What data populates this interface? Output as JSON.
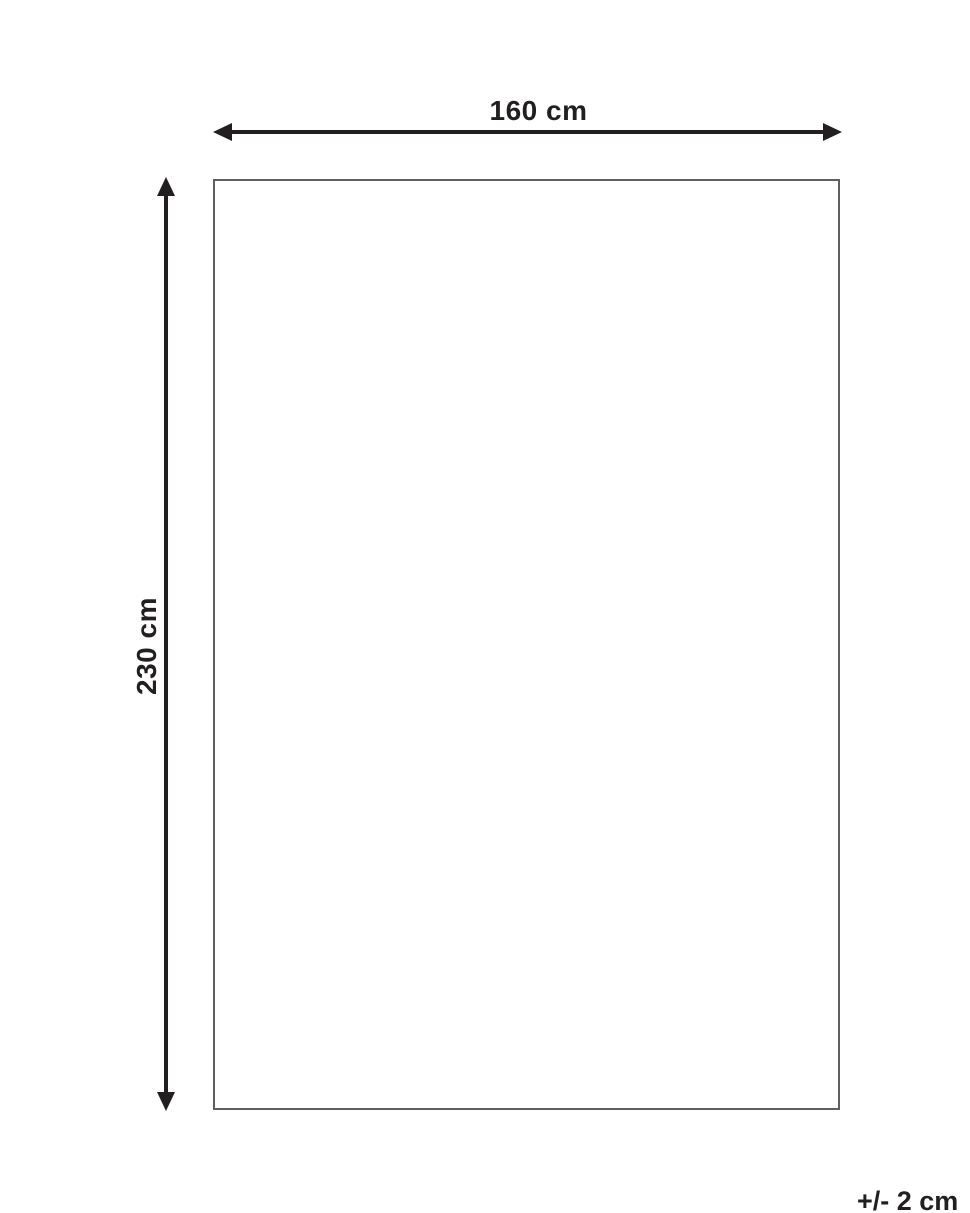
{
  "diagram": {
    "width_label": "160 cm",
    "height_label": "230 cm",
    "tolerance_label": "+/- 2 cm",
    "line_color": "#231f20",
    "rect_border_color": "#5f5f5f",
    "background_color": "#ffffff"
  }
}
